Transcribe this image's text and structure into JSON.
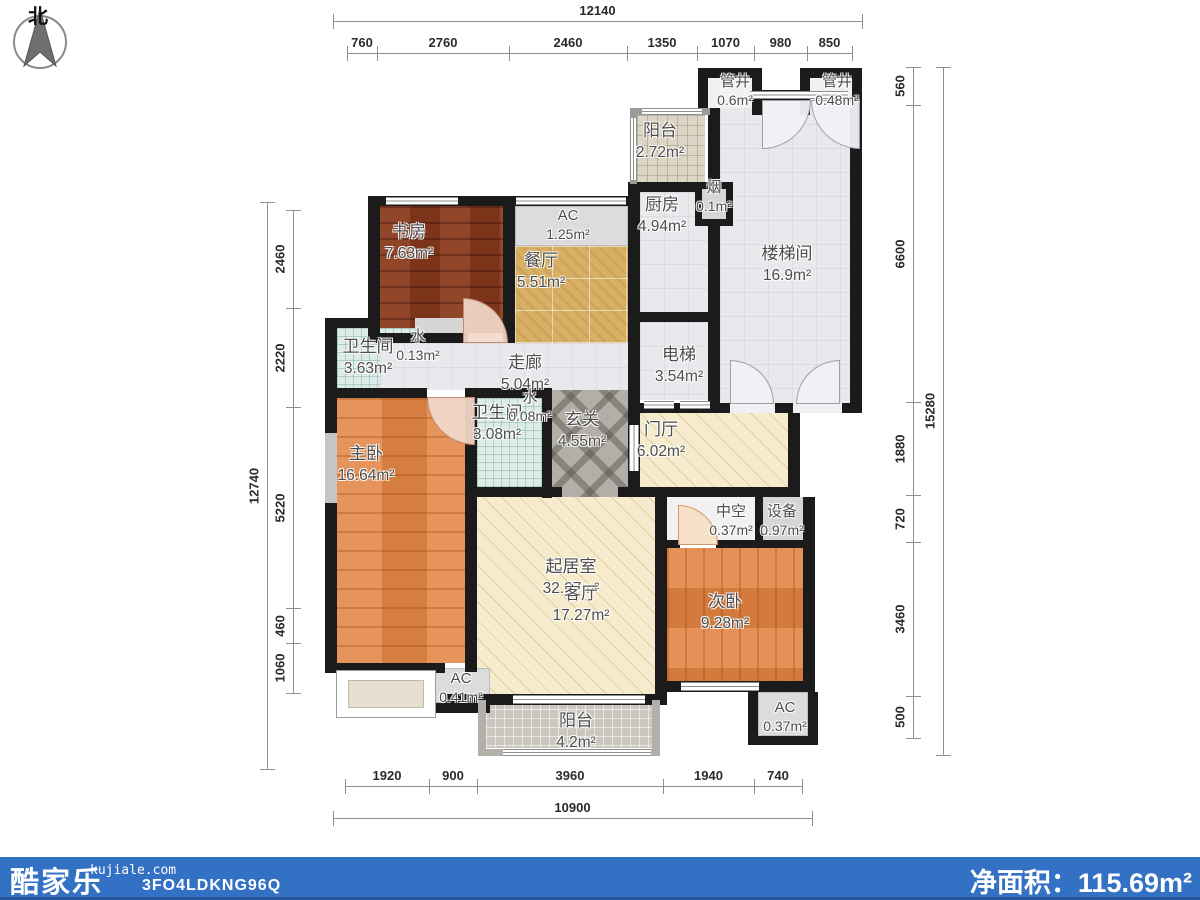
{
  "north_label": "北",
  "rooms": {
    "study": {
      "name": "书房",
      "area": "7.63m²"
    },
    "ac_top": {
      "name": "AC",
      "area": "1.25m²"
    },
    "dining": {
      "name": "餐厅",
      "area": "5.51m²"
    },
    "bath1": {
      "name": "卫生间",
      "area": "3.63m²"
    },
    "water1": {
      "name": "水",
      "area": "0.13m²"
    },
    "corridor": {
      "name": "走廊",
      "area": "5.04m²"
    },
    "kitchen": {
      "name": "厨房",
      "area": "4.94m²"
    },
    "smoke": {
      "name": "烟",
      "area": "0.1m²"
    },
    "balcony_top": {
      "name": "阳台",
      "area": "2.72m²"
    },
    "shaft1": {
      "name": "管井",
      "area": "0.6m²"
    },
    "shaft2": {
      "name": "管井",
      "area": "0.48m²"
    },
    "stairwell": {
      "name": "楼梯间",
      "area": "16.9m²"
    },
    "elevator": {
      "name": "电梯",
      "area": "3.54m²"
    },
    "bath2": {
      "name": "卫生间",
      "area": "3.08m²"
    },
    "water2": {
      "name": "水",
      "area": "0.08m²"
    },
    "entry": {
      "name": "玄关",
      "area": "4.55m²"
    },
    "foyer": {
      "name": "门厅",
      "area": "6.02m²"
    },
    "master": {
      "name": "主卧",
      "area": "16.64m²"
    },
    "living": {
      "name": "起居室",
      "area": "32.27m²"
    },
    "living_sub": {
      "name": "客厅",
      "area": "17.27m²"
    },
    "void": {
      "name": "中空",
      "area": "0.37m²"
    },
    "equipment": {
      "name": "设备",
      "area": "0.97m²"
    },
    "bedroom2": {
      "name": "次卧",
      "area": "9.28m²"
    },
    "ac_bottom_left": {
      "name": "AC",
      "area": "0.41m²"
    },
    "balcony_bottom": {
      "name": "阳台",
      "area": "4.2m²"
    },
    "ac_bottom_right": {
      "name": "AC",
      "area": "0.37m²"
    }
  },
  "dimensions": {
    "top": {
      "overall": "12140",
      "segments": [
        "760",
        "2760",
        "2460",
        "1350",
        "1070",
        "980",
        "850"
      ]
    },
    "bottom": {
      "overall": "10900",
      "segments": [
        "1920",
        "900",
        "3960",
        "1940",
        "740"
      ]
    },
    "left": {
      "overall": "12740",
      "segments": [
        "2460",
        "2220",
        "5220",
        "460",
        "1060"
      ]
    },
    "right": {
      "overall": "15280",
      "segments": [
        "560",
        "6600",
        "1880",
        "720",
        "3460",
        "500"
      ]
    }
  },
  "footer": {
    "brand": "酷家乐",
    "domain": "kujiale.com",
    "code": "3FO4LDKNG96Q",
    "net_area_label": "净面积：",
    "net_area_value": "115.69",
    "net_area_unit": "m²",
    "bar_color": "#3271c4"
  },
  "palette": {
    "wall": "#1b1b1b",
    "footer_blue": "#3271c4",
    "wood_dark": "#8a3a1d",
    "wood_orange": "#e28445",
    "tile_gold": "#d8b065",
    "tile_teal": "#dcebe7",
    "cream": "#f6eccd",
    "entry_gray": "#b3aea7"
  }
}
